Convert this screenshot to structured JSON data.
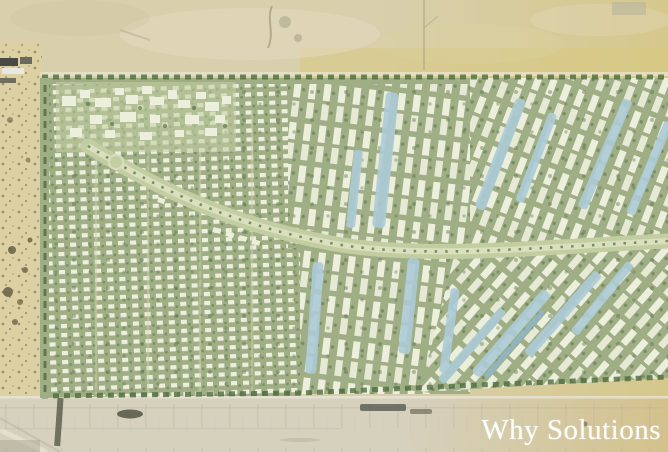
{
  "watermark": {
    "text": "Why Solutions"
  },
  "map": {
    "palette": {
      "sand-top": "#d8cfad",
      "sand-gold": "#d6c88c",
      "sand-band": "#d9c87f",
      "road-sand": "#d6d1bd",
      "road-sand-gold": "#d4c28c",
      "beach-sand": "#ddd0a2",
      "green-base": "#9fae85",
      "green-light": "#c3cda2",
      "green-pale": "#dde2c0",
      "tree-dark": "#4f6b3f",
      "roof-white": "#edefdd",
      "water-blue": "#aecbd6",
      "water-deep": "#8fb6c6",
      "watermark": "#ffffff"
    }
  }
}
